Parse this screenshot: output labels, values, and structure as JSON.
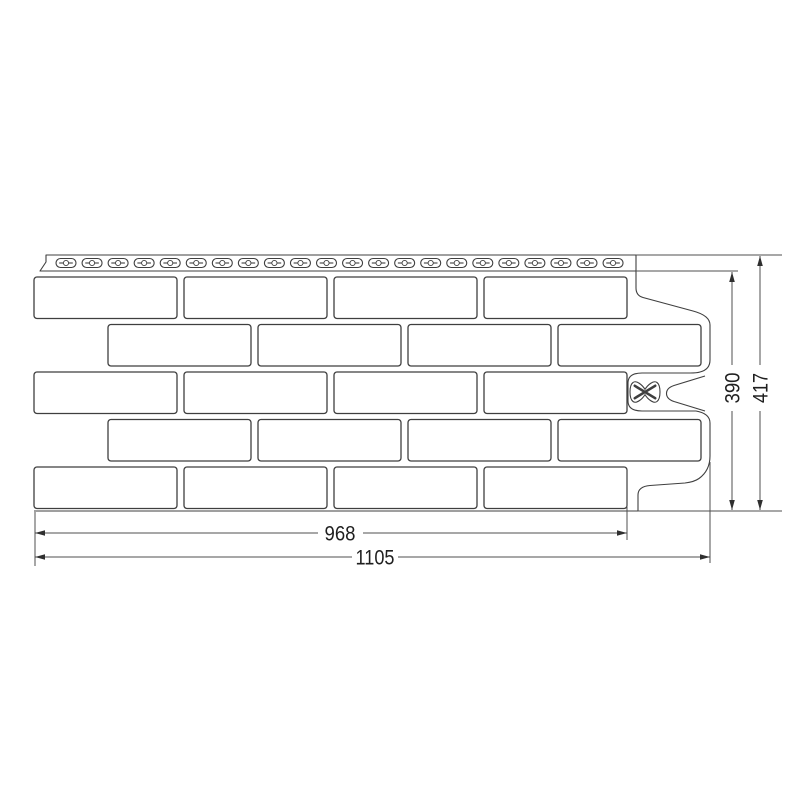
{
  "diagram": {
    "type": "technical-drawing",
    "subject": "brick-facade-panel-front-view",
    "background_color": "#ffffff",
    "line_color": "#3f3f3f",
    "text_color": "#1f1f1f"
  },
  "panel": {
    "nail_strip": {
      "slot_count": 22,
      "slot_shape": "oval-nail-slot-with-center-pin"
    },
    "brick_rows": [
      {
        "bricks": 4,
        "alignment": "left"
      },
      {
        "bricks": 4,
        "alignment": "right"
      },
      {
        "bricks": 4,
        "alignment": "left"
      },
      {
        "bricks": 4,
        "alignment": "right"
      },
      {
        "bricks": 4,
        "alignment": "left"
      }
    ],
    "right_edge": "interlock-profile-with-center-notch",
    "center_mark": "x-bowtie-alignment-mark"
  },
  "dimensions": {
    "useful_width": {
      "value": "968"
    },
    "total_width": {
      "value": "1105"
    },
    "useful_height": {
      "value": "390"
    },
    "total_height": {
      "value": "417"
    }
  }
}
